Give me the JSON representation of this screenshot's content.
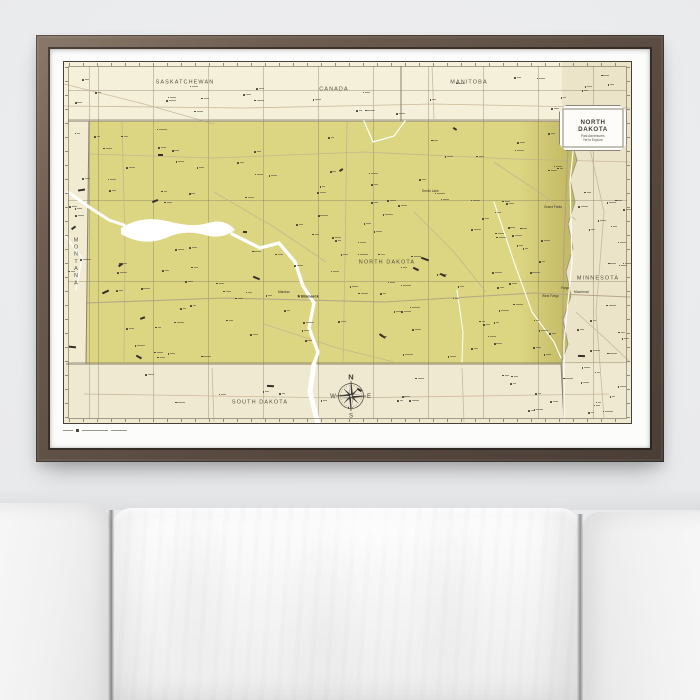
{
  "map": {
    "regions": {
      "saskatchewan": "SASKATCHEWAN",
      "canada": "CANADA",
      "manitoba": "MANITOBA",
      "montana": "MONTANA",
      "north_dakota": "NORTH DAKOTA",
      "minnesota": "MINNESOTA",
      "south_dakota": "SOUTH DAKOTA"
    },
    "cities": {
      "bismarck": "Bismarck",
      "mandan": "Mandan",
      "fargo": "Fargo",
      "moorhead": "Moorhead",
      "west_fargo": "West Fargo",
      "devils_lake": "Devils Lake",
      "grand_forks": "Grand Forks"
    },
    "capital_star": "★",
    "legend": {
      "title_line1": "NORTH",
      "title_line2": "DAKOTA",
      "item1": "Past Adventures",
      "item2": "Yet to Explore"
    },
    "compass": {
      "n": "N",
      "e": "E",
      "s": "S",
      "w": "W"
    },
    "colors": {
      "state_fill": "#dcd581",
      "paper": "#f0ebd1",
      "neighbor_fill": "#ebe4c9",
      "frame_wood": "#5a4c42",
      "water": "#ffffff"
    }
  }
}
